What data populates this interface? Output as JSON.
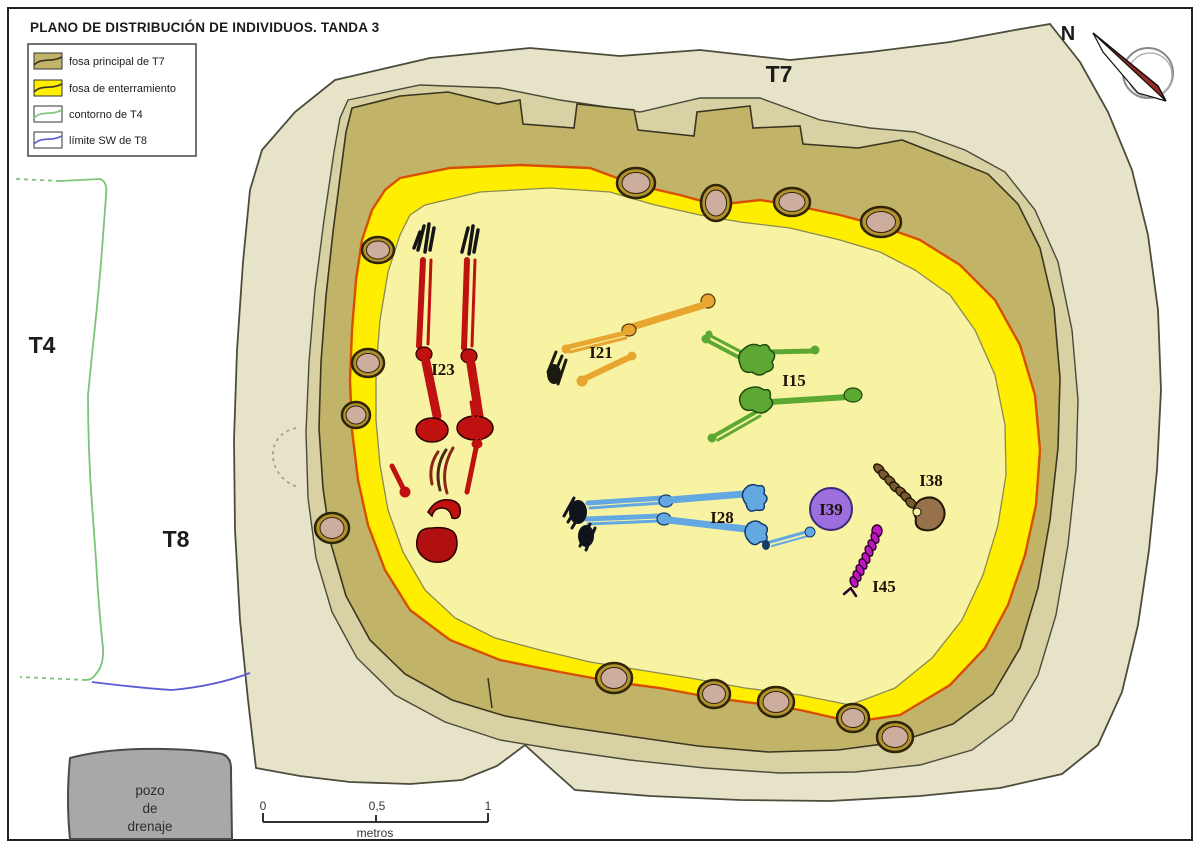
{
  "title": "PLANO DE DISTRIBUCIÓN DE INDIVIDUOS. TANDA 3",
  "legend": {
    "items": [
      {
        "label": "fosa principal de T7",
        "swatch_fill": "#c1b469",
        "line_color": "#3a3520"
      },
      {
        "label": "fosa de enterramiento",
        "swatch_fill": "#ffee00",
        "line_color": "#3a3520"
      },
      {
        "label": "contorno de T4",
        "swatch_fill": "#ffffff",
        "line_color": "#7cc576"
      },
      {
        "label": "límite SW de T8",
        "swatch_fill": "#ffffff",
        "line_color": "#5b5bd6"
      }
    ]
  },
  "compass": {
    "north_label": "N"
  },
  "trench_labels": {
    "t7": "T7",
    "t4": "T4",
    "t8": "T8"
  },
  "individuals": [
    {
      "id": "I23",
      "color": "#c01111"
    },
    {
      "id": "I21",
      "color": "#e8a52f"
    },
    {
      "id": "I15",
      "color": "#5ca832"
    },
    {
      "id": "I28",
      "color": "#64a8e2"
    },
    {
      "id": "I39",
      "color": "#9c6ede"
    },
    {
      "id": "I38",
      "color": "#96714a"
    },
    {
      "id": "I45",
      "color": "#c214c2"
    }
  ],
  "drainage_well": {
    "line1": "pozo",
    "line2": "de",
    "line3": "drenaje"
  },
  "scale_bar": {
    "tick0": "0",
    "tick05": "0,5",
    "tick1": "1",
    "unit": "metros"
  },
  "colors": {
    "outer_surface": "#e7e3c9",
    "mid_surface": "#d8d1a4",
    "fosa_principal": "#c1b469",
    "fosa_ring": "#ffee00",
    "fosa_ring_outline": "#d94f00",
    "fosa_interior": "#f8f3a3",
    "contorno_t4": "#7cc576",
    "limite_t8": "#5b5bd6",
    "stone_fill": "#cdad9d",
    "stone_ring": "#b3922f",
    "drainage_fill": "#a8a8a8",
    "north_arrow": "#992a22"
  }
}
